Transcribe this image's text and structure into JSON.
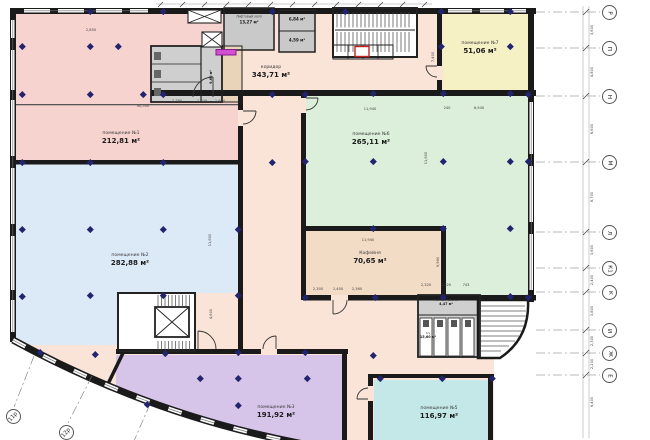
{
  "plan": {
    "rooms": [
      {
        "id": "room1",
        "name": "помещение №1",
        "area": "212,81 м²",
        "color": "#f7d3d0"
      },
      {
        "id": "room2",
        "name": "помещение №2",
        "area": "282,88 м²",
        "color": "#dce9f7"
      },
      {
        "id": "room3",
        "name": "помещение №3",
        "area": "191,92 м²",
        "color": "#d6c4e9"
      },
      {
        "id": "room5",
        "name": "помещение №5",
        "area": "116,97 м²",
        "color": "#c3e8e7"
      },
      {
        "id": "room6",
        "name": "помещение №6",
        "area": "265,11 м²",
        "color": "#dcefda"
      },
      {
        "id": "room7",
        "name": "помещение №7",
        "area": "51,06 м²",
        "color": "#f6f0c5"
      },
      {
        "id": "coffee",
        "name": "Кофейня",
        "area": "70,65 м²",
        "color": "#f3dcc6"
      },
      {
        "id": "corridor",
        "name": "коридор",
        "area": "343,71 м²",
        "color": "#fae4d7"
      },
      {
        "id": "lift-hall",
        "name": "Лифтовый холл",
        "area": "13,27 м²",
        "color": "#c9c9c9"
      },
      {
        "id": "store-a",
        "name": "",
        "area": "6,84 м²",
        "color": "#c9c9c9"
      },
      {
        "id": "store-b",
        "name": "",
        "area": "4,59 м²",
        "color": "#c9c9c9"
      },
      {
        "id": "wc",
        "name": "С/у",
        "area": "15,60 м²",
        "color": "#cfcfcf"
      },
      {
        "id": "inventory",
        "name": "Комната уб.инв.",
        "area": "4,47 м²",
        "color": "#cfcfcf"
      },
      {
        "id": "small-room",
        "name": "",
        "area": "9,60 м²",
        "color": "#cfcfcf"
      }
    ],
    "grid_right": [
      {
        "label": "Р",
        "y": 12
      },
      {
        "label": "П",
        "y": 48
      },
      {
        "label": "Н",
        "y": 96
      },
      {
        "label": "М",
        "y": 162
      },
      {
        "label": "Л",
        "y": 232
      },
      {
        "label": "К1",
        "y": 268
      },
      {
        "label": "К",
        "y": 292
      },
      {
        "label": "И",
        "y": 330
      },
      {
        "label": "Ж",
        "y": 353
      },
      {
        "label": "Е",
        "y": 375
      }
    ],
    "grid_bottom": [
      {
        "label": "11р",
        "x": 13,
        "y": 416
      },
      {
        "label": "12р",
        "x": 66,
        "y": 432
      }
    ],
    "dims": [
      {
        "t": "2,850",
        "x": 91,
        "y": 30,
        "r": 0
      },
      {
        "t": "40,500",
        "x": 143,
        "y": 106,
        "r": 0
      },
      {
        "t": "2,780",
        "x": 177,
        "y": 101,
        "r": 0
      },
      {
        "t": "1,020",
        "x": 202,
        "y": 101,
        "r": 0
      },
      {
        "t": "1,600",
        "x": 220,
        "y": 101,
        "r": 0
      },
      {
        "t": "11,940",
        "x": 370,
        "y": 109,
        "r": 0
      },
      {
        "t": "240",
        "x": 447,
        "y": 108,
        "r": 0
      },
      {
        "t": "6,940",
        "x": 479,
        "y": 108,
        "r": 0
      },
      {
        "t": "7,400",
        "x": 433,
        "y": 57,
        "r": 90
      },
      {
        "t": "11,600",
        "x": 426,
        "y": 158,
        "r": 90
      },
      {
        "t": "11,600",
        "x": 210,
        "y": 240,
        "r": 90
      },
      {
        "t": "4,600",
        "x": 211,
        "y": 314,
        "r": 90
      },
      {
        "t": "2,300",
        "x": 318,
        "y": 289,
        "r": 0
      },
      {
        "t": "1,400",
        "x": 338,
        "y": 289,
        "r": 0
      },
      {
        "t": "2,360",
        "x": 357,
        "y": 289,
        "r": 0
      },
      {
        "t": "11,940",
        "x": 368,
        "y": 240,
        "r": 0
      },
      {
        "t": "5,960",
        "x": 438,
        "y": 262,
        "r": 90
      },
      {
        "t": "2,320",
        "x": 426,
        "y": 285,
        "r": 0
      },
      {
        "t": "1,020",
        "x": 446,
        "y": 285,
        "r": 0
      },
      {
        "t": "743",
        "x": 466,
        "y": 285,
        "r": 0
      },
      {
        "t": "3,600",
        "x": 592,
        "y": 30,
        "r": 90
      },
      {
        "t": "4,800",
        "x": 592,
        "y": 72,
        "r": 90
      },
      {
        "t": "6,600",
        "x": 592,
        "y": 129,
        "r": 90
      },
      {
        "t": "6,700",
        "x": 592,
        "y": 197,
        "r": 90
      },
      {
        "t": "3,600",
        "x": 592,
        "y": 250,
        "r": 90
      },
      {
        "t": "2,400",
        "x": 592,
        "y": 280,
        "r": 90
      },
      {
        "t": "3,800",
        "x": 592,
        "y": 311,
        "r": 90
      },
      {
        "t": "2,300",
        "x": 592,
        "y": 341,
        "r": 90
      },
      {
        "t": "2,200",
        "x": 592,
        "y": 364,
        "r": 90
      },
      {
        "t": "6,400",
        "x": 592,
        "y": 402,
        "r": 90
      }
    ],
    "columns": [
      [
        90,
        11
      ],
      [
        163,
        11
      ],
      [
        272,
        11
      ],
      [
        345,
        11
      ],
      [
        441,
        11
      ],
      [
        510,
        11
      ],
      [
        22,
        46
      ],
      [
        90,
        46
      ],
      [
        118,
        46
      ],
      [
        441,
        46
      ],
      [
        510,
        46
      ],
      [
        22,
        94
      ],
      [
        90,
        94
      ],
      [
        143,
        94
      ],
      [
        163,
        94
      ],
      [
        272,
        94
      ],
      [
        305,
        94
      ],
      [
        373,
        93
      ],
      [
        443,
        93
      ],
      [
        510,
        93
      ],
      [
        528,
        94
      ],
      [
        22,
        162
      ],
      [
        90,
        162
      ],
      [
        163,
        162
      ],
      [
        272,
        162
      ],
      [
        305,
        161
      ],
      [
        373,
        161
      ],
      [
        443,
        161
      ],
      [
        510,
        161
      ],
      [
        528,
        161
      ],
      [
        22,
        229
      ],
      [
        90,
        229
      ],
      [
        163,
        229
      ],
      [
        238,
        229
      ],
      [
        373,
        228
      ],
      [
        443,
        228
      ],
      [
        510,
        228
      ],
      [
        22,
        296
      ],
      [
        90,
        295
      ],
      [
        163,
        295
      ],
      [
        238,
        295
      ],
      [
        305,
        297
      ],
      [
        375,
        297
      ],
      [
        443,
        297
      ],
      [
        510,
        296
      ],
      [
        528,
        297
      ],
      [
        40,
        352
      ],
      [
        95,
        354
      ],
      [
        165,
        353
      ],
      [
        238,
        352
      ],
      [
        305,
        352
      ],
      [
        373,
        355
      ],
      [
        200,
        378
      ],
      [
        238,
        378
      ],
      [
        307,
        378
      ],
      [
        380,
        378
      ],
      [
        442,
        378
      ],
      [
        492,
        378
      ],
      [
        147,
        404
      ],
      [
        238,
        405
      ]
    ]
  }
}
